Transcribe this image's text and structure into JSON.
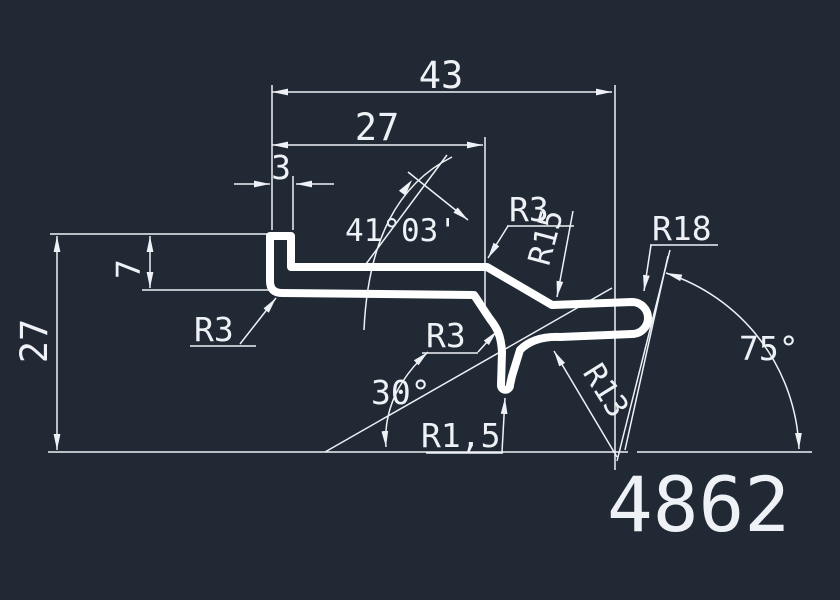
{
  "drawing": {
    "part_number": "4862",
    "colors": {
      "background": "#212935",
      "line": "#eef2f6",
      "profile": "#ffffff"
    },
    "labels": {
      "dim_43": "43",
      "dim_27_top": "27",
      "dim_3": "3",
      "dim_7": "7",
      "dim_27_left": "27",
      "angle_41": "41°03'",
      "angle_30": "30°",
      "angle_75": "75°",
      "radius_r3_upper": "R3",
      "radius_r15": "R15",
      "radius_r18": "R18",
      "radius_r13": "R13",
      "radius_r3_left": "R3",
      "radius_r3_lower": "R3",
      "radius_r1_5": "R1,5"
    }
  }
}
